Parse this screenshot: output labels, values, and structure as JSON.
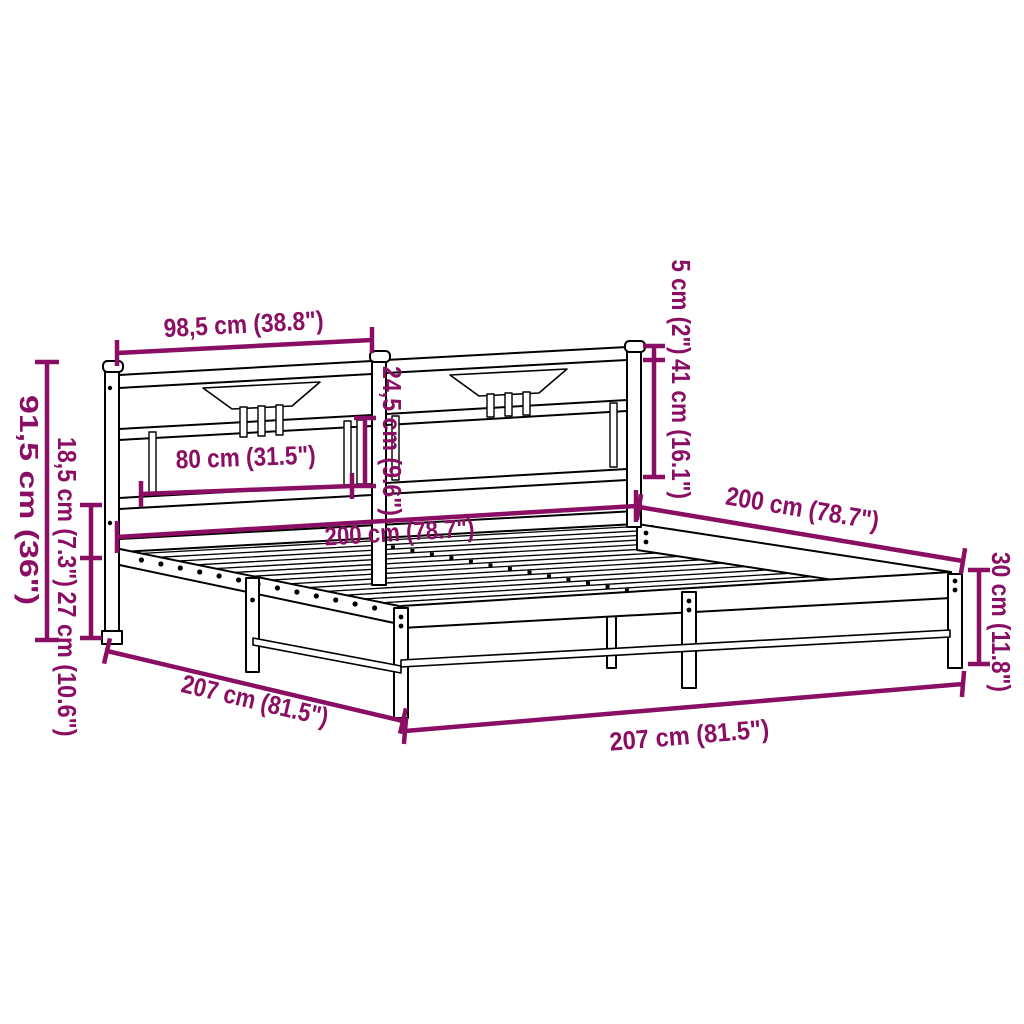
{
  "title": "Bed frame dimension diagram",
  "colors": {
    "dimension": "#8A0E63",
    "line_art": "#000000",
    "background": "#FFFFFF"
  },
  "dimensions": {
    "headboard_section_width": {
      "label": "98,5 cm (38.8\")"
    },
    "post_top_offset": {
      "label": "5 cm (2\")"
    },
    "headboard_upper_height": {
      "label": "41 cm (16.1\")"
    },
    "panel_opening_height": {
      "label": "24,5 cm (9.6\")"
    },
    "panel_opening_width": {
      "label": "80 cm (31.5\")"
    },
    "headboard_total_height": {
      "label": "91,5 cm (36\")"
    },
    "frame_top_height": {
      "label": "18,5 cm (7.3\")"
    },
    "underbed_clearance": {
      "label": "27 cm (10.6\")"
    },
    "bed_width": {
      "label": "200 cm (78.7\")"
    },
    "bed_length": {
      "label": "200 cm (78.7\")"
    },
    "side_rail_height": {
      "label": "30 cm (11.8\")"
    },
    "frame_length": {
      "label": "207 cm (81.5\")"
    },
    "frame_width": {
      "label": "207 cm (81.5\")"
    }
  }
}
